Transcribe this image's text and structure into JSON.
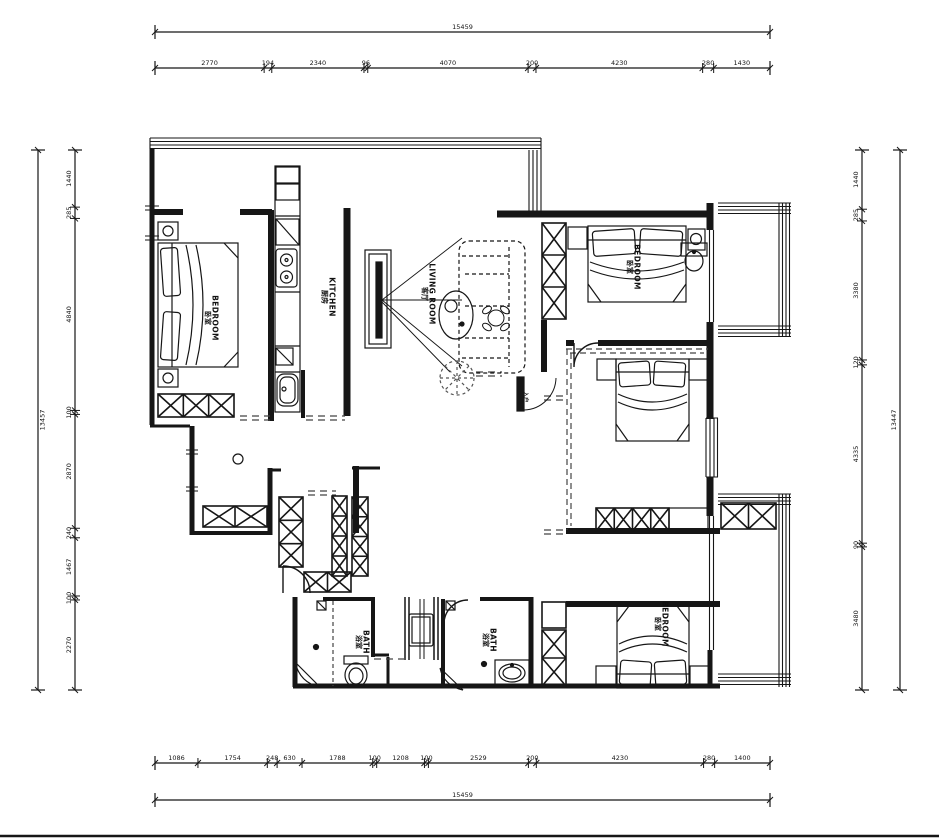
{
  "labels": {
    "bedroom_left": {
      "en": "BEDROOM",
      "zh": "卧室"
    },
    "kitchen": {
      "en": "KITCHEN",
      "zh": "厨房"
    },
    "living_room": {
      "en": "LIVING ROOM",
      "zh": "客厅"
    },
    "bedroom_top_right": {
      "en": "BEDROOM",
      "zh": "卧室"
    },
    "bedroom_bottom_right": {
      "en": "BEDROOM",
      "zh": "卧室"
    },
    "bath_left": {
      "en": "BATH",
      "zh": "浴室"
    },
    "bath_right": {
      "en": "BATH",
      "zh": "浴室"
    },
    "entry": {
      "zh": "入户"
    }
  },
  "dimensions": {
    "top": {
      "overall": "15459",
      "segments": [
        "2770",
        "194",
        "2340",
        "96",
        "4070",
        "200",
        "4230",
        "280",
        "1430"
      ]
    },
    "bottom": {
      "overall": "15459",
      "segments": [
        "1086",
        "1754",
        "248",
        "630",
        "1788",
        "100",
        "1208",
        "100",
        "2529",
        "200",
        "4230",
        "280",
        "1400"
      ]
    },
    "left": {
      "overall": "13457",
      "segments": [
        "1440",
        "285",
        "4840",
        "100",
        "2870",
        "240",
        "1467",
        "100",
        "2270"
      ]
    },
    "right": {
      "overall": "13447",
      "segments": [
        "1440",
        "285",
        "3380",
        "120",
        "4335",
        "90",
        "3480"
      ]
    }
  },
  "colors": {
    "line": "#161616",
    "background": "#ffffff"
  }
}
